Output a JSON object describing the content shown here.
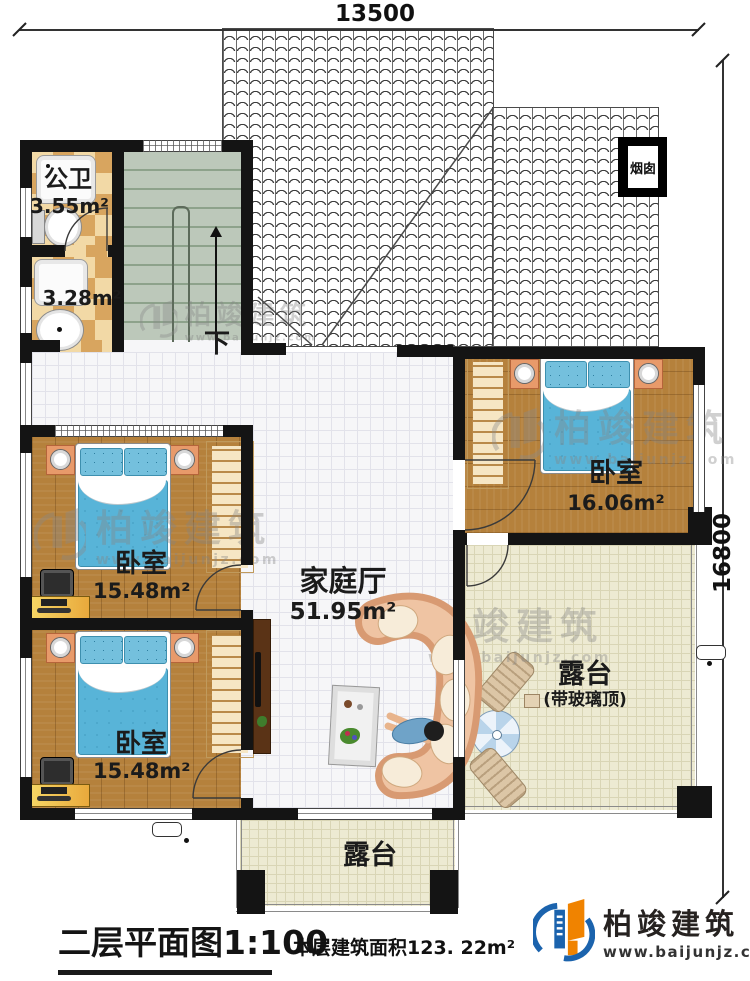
{
  "dimensions": {
    "top": "13500",
    "right": "16800"
  },
  "roof": {
    "chimney_label": "烟囱"
  },
  "rooms": {
    "bath1": {
      "name": "公卫",
      "area": "3.55m²"
    },
    "bath2": {
      "area": "3.28m²"
    },
    "stairs": {
      "down_label": "下"
    },
    "bedrooms": [
      {
        "name": "卧室",
        "area": "16.06m²"
      },
      {
        "name": "卧室",
        "area": "15.48m²"
      },
      {
        "name": "卧室",
        "area": "15.48m²"
      }
    ],
    "family_hall": {
      "name": "家庭厅",
      "area": "51.95m²"
    },
    "terrace_glass": {
      "name": "露台",
      "roof_note": "(带玻璃顶)"
    },
    "terrace_bottom": {
      "name": "露台"
    }
  },
  "titleblock": {
    "title": "二层平面图",
    "scale": "1:100",
    "area_note": "本层建筑面积123. 22m²"
  },
  "logo": {
    "name": "柏竣建筑",
    "url": "www.baijunjz.com"
  },
  "watermark": {
    "name": "柏竣建筑",
    "url": "www.baijunjz.com"
  },
  "colors": {
    "wall": "#141414",
    "wood": "#b5813c",
    "bedding": "#58b4d8",
    "checker": "#d8a55f",
    "stair": "#bcc8ba",
    "terrace": "#edead2",
    "logo_blue": "#1b63ad",
    "logo_orange": "#f08300"
  }
}
